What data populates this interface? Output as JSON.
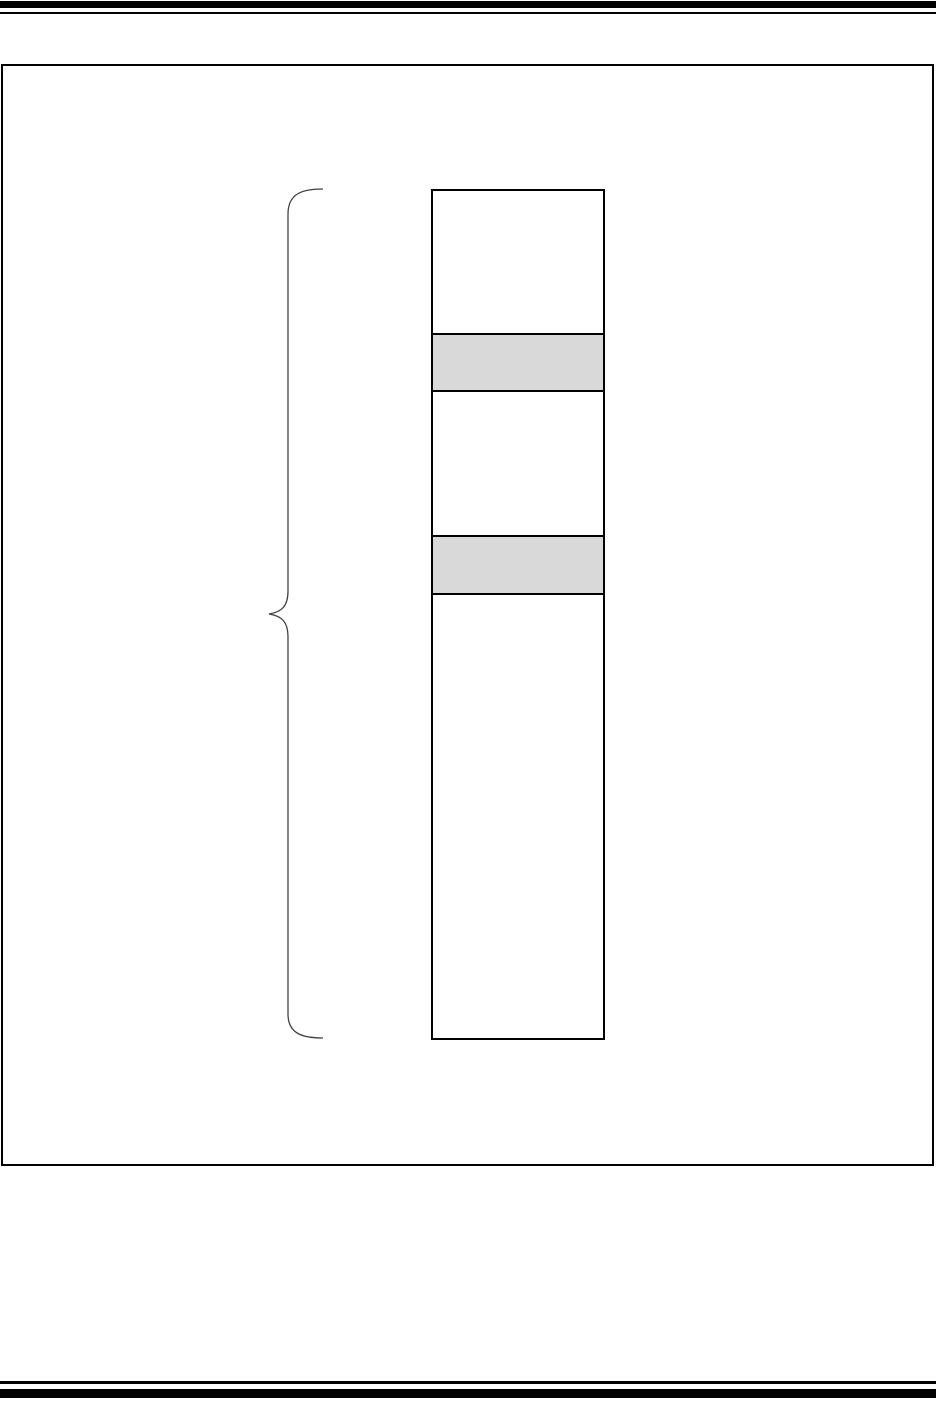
{
  "page": {
    "background": "#ffffff",
    "rule_color": "#000000",
    "header": {
      "thick_rule": true,
      "thin_rule": true
    },
    "footer": {
      "thin_rule": true,
      "thick_rule": true
    }
  },
  "figure": {
    "frame_border_color": "#000000",
    "frame_fill": "#ffffff",
    "brace": {
      "side": "left",
      "stroke_color": "#404040"
    },
    "memory_column": {
      "border_color": "#000000",
      "separator_color": "#000000",
      "shaded_fill": "#d9d9d9",
      "plain_fill": "#ffffff",
      "segments": [
        {
          "shaded": false,
          "fill": "#ffffff",
          "height_px": 142
        },
        {
          "shaded": true,
          "fill": "#d9d9d9",
          "height_px": 57
        },
        {
          "shaded": false,
          "fill": "#ffffff",
          "height_px": 145
        },
        {
          "shaded": true,
          "fill": "#d9d9d9",
          "height_px": 58
        },
        {
          "shaded": false,
          "fill": "#ffffff",
          "height_px": 444
        }
      ]
    }
  }
}
